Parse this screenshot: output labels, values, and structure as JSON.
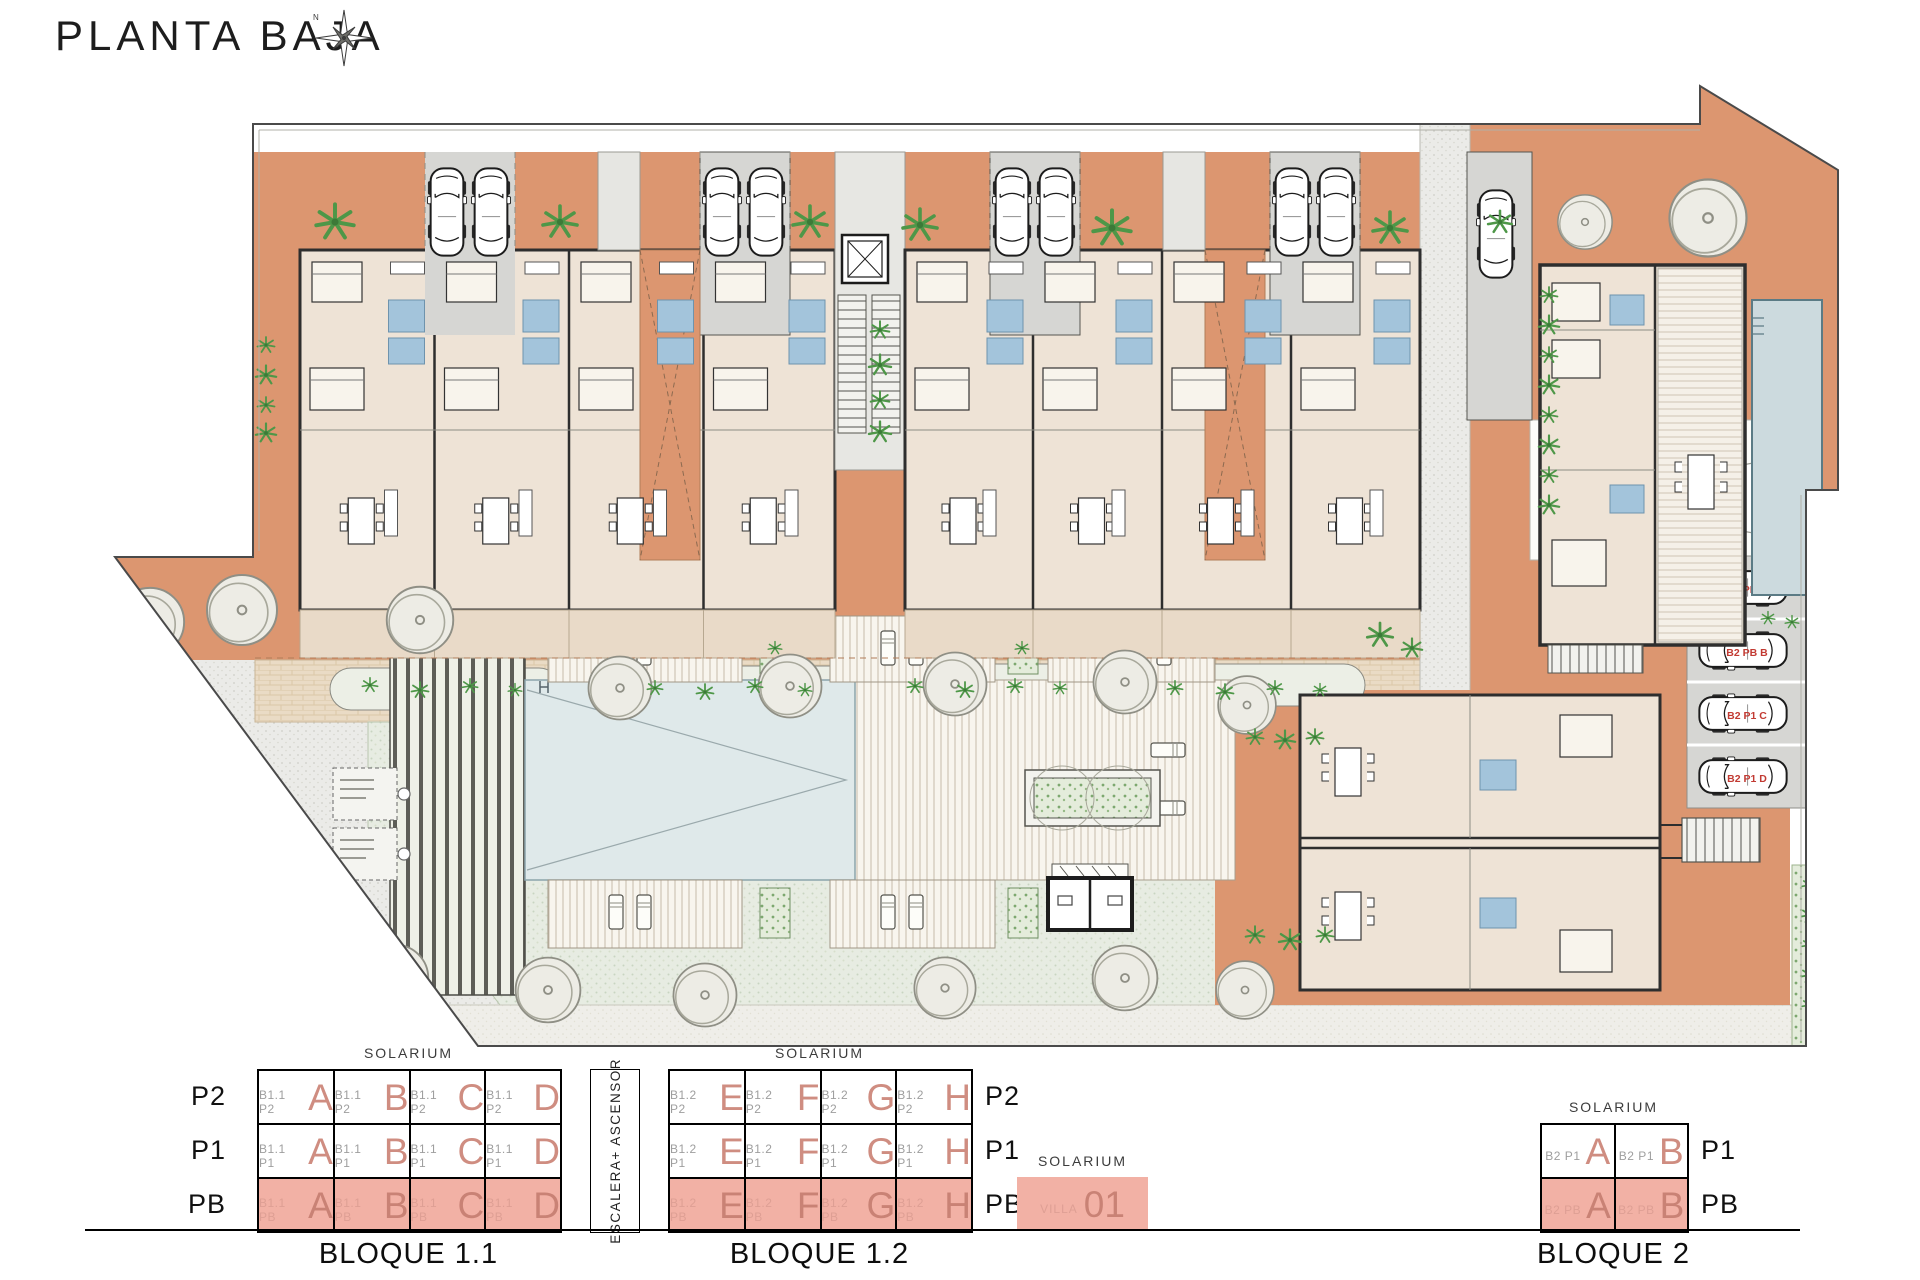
{
  "title": "PLANTA BAJA",
  "compass": {
    "north_label": "N"
  },
  "colors": {
    "terrace": "#dc9670",
    "building": "#eee3d6",
    "porch": "#e9dac8",
    "garage": "#d6d6d3",
    "wall": "#2e2e2e",
    "bath": "#a3c4db",
    "pool": "#dfe9ea",
    "plant": "#4e9748",
    "highlight": "#f2b1a5",
    "letter": "#cf8d81",
    "letter_pink": "#c98275",
    "prefix": "#9e9e9e",
    "prefix_pink": "#de9f94",
    "parking_label": "#c23a32"
  },
  "legend": {
    "solarium_label": "SOLARIUM",
    "stair_box_label": "ESCALERA+ ASCENSOR",
    "blocks": [
      {
        "id": "bloque-1-1",
        "caption": "BLOQUE 1.1",
        "floor_labels_side": "left",
        "floors": [
          {
            "label": "P2",
            "prefix": "B1.1 P2",
            "units": [
              "A",
              "B",
              "C",
              "D"
            ],
            "highlight": false
          },
          {
            "label": "P1",
            "prefix": "B1.1 P1",
            "units": [
              "A",
              "B",
              "C",
              "D"
            ],
            "highlight": false
          },
          {
            "label": "PB",
            "prefix": "B1.1 PB",
            "units": [
              "A",
              "B",
              "C",
              "D"
            ],
            "highlight": true
          }
        ]
      },
      {
        "id": "bloque-1-2",
        "caption": "BLOQUE 1.2",
        "floor_labels_side": "right",
        "floors": [
          {
            "label": "P2",
            "prefix": "B1.2 P2",
            "units": [
              "E",
              "F",
              "G",
              "H"
            ],
            "highlight": false
          },
          {
            "label": "P1",
            "prefix": "B1.2 P1",
            "units": [
              "E",
              "F",
              "G",
              "H"
            ],
            "highlight": false
          },
          {
            "label": "PB",
            "prefix": "B1.2 PB",
            "units": [
              "E",
              "F",
              "G",
              "H"
            ],
            "highlight": true
          }
        ]
      },
      {
        "id": "bloque-2",
        "caption": "BLOQUE 2",
        "floor_labels_side": "right",
        "floors": [
          {
            "label": "P1",
            "prefix": "B2 P1",
            "units": [
              "A",
              "B"
            ],
            "highlight": false
          },
          {
            "label": "PB",
            "prefix": "B2 PB",
            "units": [
              "A",
              "B"
            ],
            "highlight": true
          }
        ]
      }
    ],
    "villa": {
      "solarium_label": "SOLARIUM",
      "name": "VILLA",
      "number": "01"
    }
  },
  "parking": {
    "space_labels": [
      "B2 PB A",
      "B2 PB B",
      "B2 P1 C",
      "B2 P1 D"
    ]
  }
}
